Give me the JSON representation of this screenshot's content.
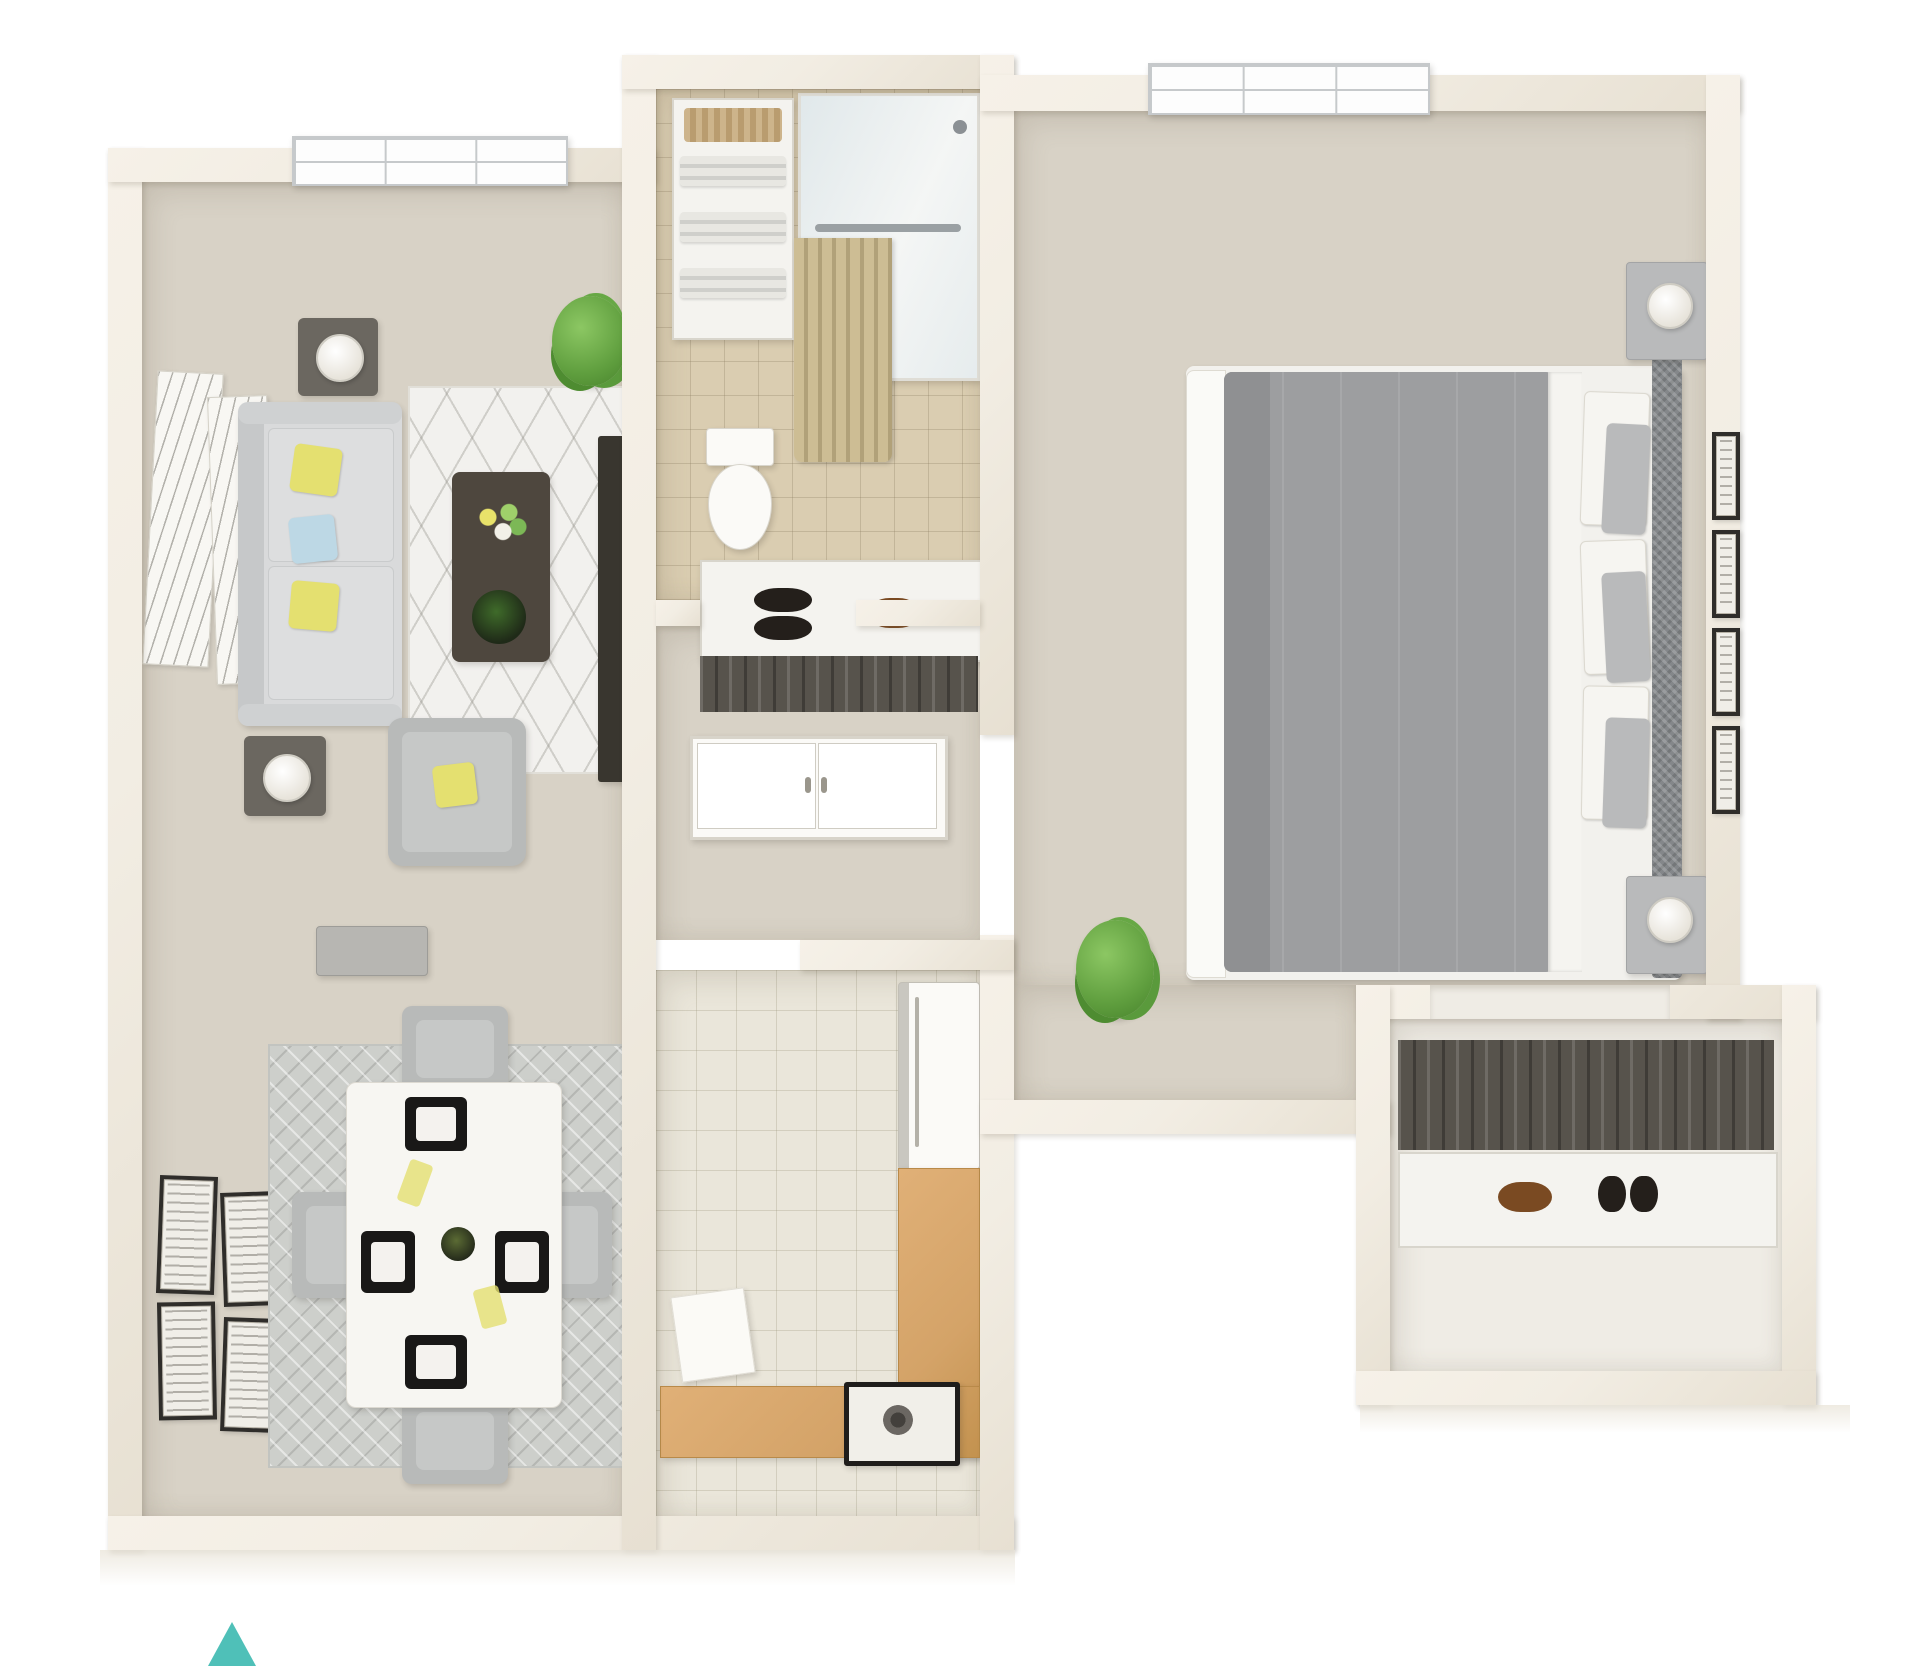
{
  "scene": {
    "type": "3d-apartment-floor-plan",
    "visible_text": "none",
    "compass": {
      "symbol": "triangle-up",
      "position": "bottom-left"
    }
  },
  "palette": {
    "background": "#ffffff",
    "wall": "#f2ede3",
    "wall_deep": "#e7e0d2",
    "floor_main": "#d8d2c6",
    "floor_bath": "#dacdb1",
    "floor_kitchen": "#eae6da",
    "counter": "#d4a368",
    "sofa": "#d9dadb",
    "pillow_yellow": "#e4e070",
    "pillow_blue": "#bdd8e5",
    "rug_living": "#f2f1ee",
    "rug_dining": "#cdcfcb",
    "wood_dark": "#4e473e",
    "tv_dark": "#39362f",
    "duvet": "#9d9ea0",
    "duvet_deep": "#8f9092",
    "headboard": "#84878a",
    "closet_dark": "#57534c",
    "plant": "#5f9e3e",
    "curtain": "#c9b98f",
    "frame_dark": "#2f2d2a",
    "chair_gray": "#b8bab9",
    "glass": "#d7e2e6",
    "compass_color": "#4fc0b8"
  },
  "inventory": {
    "living_room": [
      "window",
      "leaning-wall-art",
      "side-tables-with-lamps",
      "sofa-with-yellow-blue-pillows",
      "geometric-area-rug",
      "coffee-table-with-flowers-and-plant-bowl",
      "tv-stand",
      "armchair-with-yellow-pillow",
      "floor-plant",
      "media-console"
    ],
    "dining_area": [
      "four-wall-frames",
      "diamond-area-rug",
      "white-dining-table",
      "four-gray-chairs",
      "four-black-placemats",
      "centerpiece"
    ],
    "bathroom": [
      "linen-shelves-with-towels",
      "wicker-basket",
      "shower-with-grab-bar",
      "tan-shower-curtain",
      "toilet"
    ],
    "hallway": [
      "hall-closet-shelf",
      "black-shoes",
      "brown-shoe",
      "hanging-clothes",
      "entry-double-door"
    ],
    "kitchen": [
      "refrigerator",
      "l-shaped-wood-counter",
      "stove",
      "floor-mat"
    ],
    "bedroom": [
      "window",
      "bed-with-gray-duvet",
      "patterned-headboard",
      "white-and-gray-pillows",
      "two-nightstands-with-lamps",
      "four-wall-frames",
      "floor-plant",
      "walk-in-closet",
      "hanging-clothes",
      "shoes"
    ]
  }
}
